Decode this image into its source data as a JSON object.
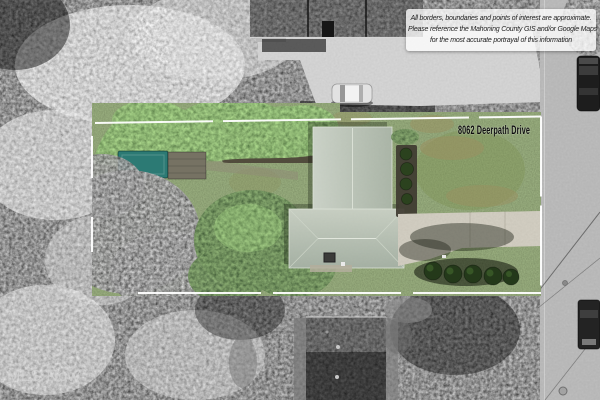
{
  "annotation": {
    "address_label": "8062 Deerpath Drive",
    "disclaimer": {
      "line1": "All borders, boundaries and points of interest are approximate.",
      "line2": "Please reference the Mahoning County GIS and/or Google Maps",
      "line3": "for the most accurate portrayal of this information"
    },
    "watermark": "MLS Now"
  },
  "colors": {
    "boundary": "#ffffff",
    "road": "#9b9b9b",
    "subject_roof_light": "#c8d0c4",
    "subject_roof_dark": "#a3af9f",
    "driveway": "#c6bfab",
    "teal_shed": "#2c7a74",
    "lawn_green": "#647f41",
    "label_text": "#0d0d0d",
    "disclaimer_text": "#222222"
  }
}
